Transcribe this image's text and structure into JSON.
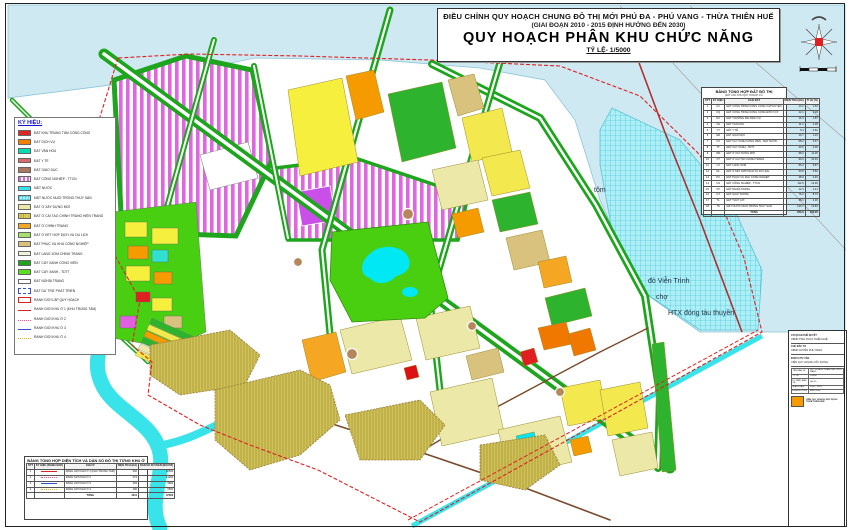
{
  "title_block": {
    "line1": "ĐIỀU CHỈNH QUY HOẠCH CHUNG ĐÔ THỊ MỚI PHÚ ĐA - PHÚ VANG - THỪA THIÊN HUẾ",
    "line2": "(GIAI ĐOẠN 2010 - 2015 ĐỊNH HƯỚNG ĐẾN 2030)",
    "line3": "QUY HOẠCH PHÂN KHU CHỨC NĂNG",
    "line4": "TỶ LỆ- 1/5000"
  },
  "legend": {
    "title": "KÝ HIỆU:",
    "items": [
      {
        "label": "ĐẤT KHU TRUNG TÂM CÔNG CỘNG",
        "swatch": {
          "type": "solid",
          "color": "#e02525"
        }
      },
      {
        "label": "ĐẤT DỊCH VỤ",
        "swatch": {
          "type": "solid",
          "color": "#f57f00"
        }
      },
      {
        "label": "ĐẤT VĂN HÓA",
        "swatch": {
          "type": "solid",
          "color": "#00dfae"
        }
      },
      {
        "label": "ĐẤT Y TẾ",
        "swatch": {
          "type": "solid",
          "color": "#d96a6a"
        }
      },
      {
        "label": "ĐẤT GIÁO DỤC",
        "swatch": {
          "type": "solid",
          "color": "#a9785f"
        }
      },
      {
        "label": "ĐẤT CÔNG NGHIỆP - TTCN",
        "swatch": {
          "type": "stripes",
          "color": "#e066e0",
          "color2": "#ffffff"
        }
      },
      {
        "label": "MẶT NƯỚC",
        "swatch": {
          "type": "solid",
          "color": "#35e3f0"
        }
      },
      {
        "label": "MẶT NƯỚC NUÔI TRỒNG THỦY SẢN",
        "swatch": {
          "type": "cross",
          "color": "#aeeef6",
          "color2": "#2bbfd4"
        }
      },
      {
        "label": "ĐẤT Ở XÂY DỰNG MỚI",
        "swatch": {
          "type": "solid",
          "color": "#ece9a8"
        }
      },
      {
        "label": "ĐẤT Ở CẢI TẠO CHỈNH TRANG HIỆN TRẠNG",
        "swatch": {
          "type": "hatch",
          "color": "#ded05e",
          "color2": "#b8a92f"
        }
      },
      {
        "label": "ĐẤT Ở CHỈNH TRANG",
        "swatch": {
          "type": "solid",
          "color": "#f5a623"
        }
      },
      {
        "label": "ĐẤT Ở KẾT HỢP DỊCH VỤ DU LỊCH",
        "swatch": {
          "type": "solid",
          "color": "#a5e06a"
        }
      },
      {
        "label": "ĐẤT PHỤC VỤ KHU CÔNG NGHIỆP",
        "swatch": {
          "type": "solid",
          "color": "#d9c27e"
        }
      },
      {
        "label": "ĐẤT LÀNG XÓM CHỈNH TRANG",
        "swatch": {
          "type": "solid",
          "color": "#eef2da"
        }
      },
      {
        "label": "ĐẤT CÂY XANH CÔNG VIÊN",
        "swatch": {
          "type": "solid",
          "color": "#1ea51e"
        }
      },
      {
        "label": "ĐẤT CÂY XANH - TDTT",
        "swatch": {
          "type": "solid",
          "color": "#5ddd1f"
        }
      },
      {
        "label": "ĐẤT NGHĨA TRANG",
        "swatch": {
          "type": "solid",
          "color": "#ffffff"
        }
      },
      {
        "label": "ĐẤT DỰ TRỮ PHÁT TRIỂN",
        "swatch": {
          "type": "outline-dashed",
          "color": "#3355cc"
        }
      },
      {
        "label": "RANH GIỚI LẬP QUY HOẠCH",
        "swatch": {
          "type": "outline-solid",
          "color": "#dd2222"
        }
      },
      {
        "label": "RANH GIỚI KHU Ở 1 (KHU TRUNG TÂM)",
        "swatch": {
          "type": "line",
          "color": "#dd2222",
          "style": "solid"
        }
      },
      {
        "label": "RANH GIỚI KHU Ở 2",
        "swatch": {
          "type": "line",
          "color": "#ee55aa",
          "style": "dotted"
        }
      },
      {
        "label": "RANH GIỚI KHU Ở 3",
        "swatch": {
          "type": "line",
          "color": "#3355cc",
          "style": "solid"
        }
      },
      {
        "label": "RANH GIỚI KHU Ở 4",
        "swatch": {
          "type": "line",
          "color": "#ddbb00",
          "style": "dotted"
        }
      }
    ]
  },
  "land_use_table": {
    "title": "BẢNG TỔNG HỢP ĐẤT ĐÔ THỊ",
    "subtitle": "ĐẤT CÁC KHU QUY HOẠCH CŨ",
    "columns": [
      "STT",
      "KÝ HIỆU",
      "LOẠI ĐẤT",
      "DIỆN TÍCH (HA)",
      "TỈ LỆ (%)"
    ],
    "rows": [
      [
        "1",
        "CC",
        "ĐẤT CÔNG TRÌNH CÔNG CỘNG CẤP HUYỆN",
        "14.2",
        "1.63"
      ],
      [
        "2",
        "CQ",
        "ĐẤT CÔNG TRÌNH CÔNG CỘNG ĐƠN VỊ Ở",
        "12.1",
        "1.39"
      ],
      [
        "3",
        "DV",
        "ĐẤT THƯƠNG MẠI DỊCH VỤ",
        "16.3",
        "1.87"
      ],
      [
        "4",
        "VH",
        "ĐẤT VĂN HÓA",
        "11.2",
        "1.28"
      ],
      [
        "5",
        "YT",
        "ĐẤT Y TẾ",
        "5.4",
        "0.62"
      ],
      [
        "6",
        "GD",
        "ĐẤT GIÁO DỤC",
        "10.7",
        "1.23"
      ],
      [
        "7",
        "CX",
        "ĐẤT CÂY XANH CÔNG VIÊN - MẶT NƯỚC",
        "58.2",
        "6.67"
      ],
      [
        "8",
        "TT",
        "ĐẤT CÂY XANH - TDTT",
        "20.6",
        "2.36"
      ],
      [
        "9",
        "OM",
        "ĐẤT Ở XÂY DỰNG MỚI",
        "98.2",
        "11.25"
      ],
      [
        "10",
        "CT",
        "ĐẤT Ở CẢI TẠO CHỈNH TRANG",
        "90.3",
        "10.34"
      ],
      [
        "11",
        "LX",
        "ĐẤT LÀNG XÓM",
        "86.2",
        "9.87"
      ],
      [
        "12",
        "DL",
        "ĐẤT Ở KẾT HỢP DỊCH VỤ DU LỊCH",
        "50.8",
        "5.82"
      ],
      [
        "13",
        "PC",
        "ĐẤT PHỤC VỤ KHU CÔNG NGHIỆP",
        "38.9",
        "4.46"
      ],
      [
        "14",
        "CN",
        "ĐẤT CÔNG NGHIỆP - TTCN",
        "112.6",
        "12.90"
      ],
      [
        "15",
        "NT",
        "ĐẤT NGHĨA TRANG",
        "12.3",
        "1.41"
      ],
      [
        "16",
        "GT",
        "ĐẤT GIAO THÔNG",
        "76.2",
        "8.73"
      ],
      [
        "17",
        "TL",
        "ĐẤT THỦY LỢI",
        "38.1",
        "4.36"
      ],
      [
        "18",
        "TS",
        "MẶT NƯỚC NUÔI TRỒNG THỦY SẢN",
        "120.7",
        "13.83"
      ]
    ],
    "total": {
      "label": "TỔNG",
      "area": "873.0",
      "percent": "100.00"
    }
  },
  "zones_table": {
    "title": "BẢNG TỔNG HỢP DIỆN TÍCH VÀ DÂN SỐ ĐÔ THỊ TỪNG KHU Ở",
    "columns": [
      "STT",
      "KÝ HIỆU (RANH GIỚI)",
      "KHU Ở",
      "DIỆN TÍCH (HA)",
      "DÂN SỐ DỰ KIẾN (NGƯỜI)"
    ],
    "rows": [
      {
        "stt": "1",
        "line": {
          "color": "#dd2222",
          "style": "solid"
        },
        "zone": "RANH GIỚI KHU Ở 1 (KHU TRUNG TÂM)",
        "area": "262",
        "population": "10500"
      },
      {
        "stt": "2",
        "line": {
          "color": "#ee55aa",
          "style": "dotted"
        },
        "zone": "RANH GIỚI KHU Ở 2",
        "area": "274",
        "population": "11200"
      },
      {
        "stt": "3",
        "line": {
          "color": "#3355cc",
          "style": "solid"
        },
        "zone": "RANH GIỚI KHU Ở 3",
        "area": "293",
        "population": "9800"
      },
      {
        "stt": "4",
        "line": {
          "color": "#ddbb00",
          "style": "dotted"
        },
        "zone": "RANH GIỚI KHU Ở 4",
        "area": "182",
        "population": "5500"
      }
    ],
    "total": {
      "label": "TỔNG",
      "area": "1011",
      "population": "37000"
    }
  },
  "sheet_block": {
    "sections": [
      {
        "label": "CƠ QUAN PHÊ DUYỆT",
        "value": "UBND TỈNH THỪA THIÊN HUẾ"
      },
      {
        "label": "CHỦ ĐẦU TƯ",
        "value": "UBND HUYỆN PHÚ VANG"
      },
      {
        "label": "ĐƠN VỊ TƯ VẤN",
        "value": "VIỆN QUY HOẠCH XÂY DỰNG"
      }
    ],
    "drawing_info": {
      "rows": [
        [
          "TÊN BẢN VẼ",
          "QUY HOẠCH PHÂN KHU CHỨC NĂNG"
        ],
        [
          "TỶ LỆ",
          "1/5000"
        ],
        [
          "KÝ HIỆU BẢN VẼ",
          "QH-05"
        ],
        [
          "GIAI ĐOẠN",
          "2010 - 2015"
        ],
        [
          "ĐỊNH HƯỚNG",
          "ĐẾN 2030"
        ]
      ]
    },
    "footer_org": "VIỆN QUY HOẠCH XÂY DỰNG THỪA THIÊN HUẾ"
  },
  "map_labels": {
    "shrimp": "tôm",
    "ferry": "đò Viễn Trình",
    "market": "chợ",
    "cooperative": "HTX đóng tàu thuyền"
  },
  "colors": {
    "water": "#cfe9f3",
    "aquaculture": "#aeeef6",
    "industrial_stripe": "#e066e0",
    "road_green": "#1ea51e",
    "park_green": "#49cf10",
    "lake_cyan": "#00e8f4",
    "boundary_red": "#dd2222",
    "village_olive": "#cfc25a"
  }
}
